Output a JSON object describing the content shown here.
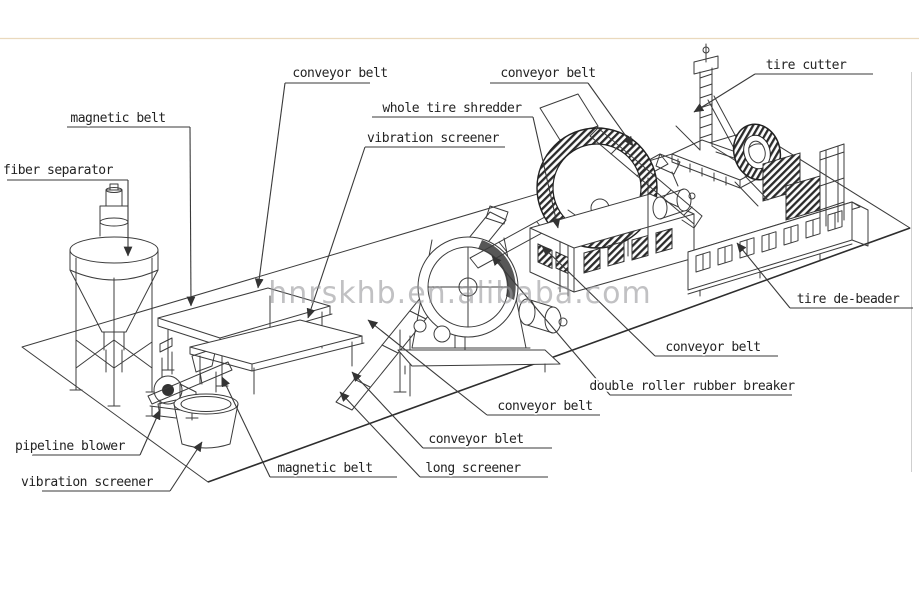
{
  "diagram": {
    "type": "isometric technical line drawing",
    "subject": "waste tire recycling production line",
    "watermark": "hnrskhb.en.alibaba.com",
    "colors": {
      "line": "#3c3c3c",
      "watermark": "#98989c",
      "top_rule": "#ead9bd",
      "background": "#ffffff"
    },
    "labels": [
      {
        "id": "conveyor-belt-top-left",
        "text": "conveyor belt"
      },
      {
        "id": "magnetic-belt-upper",
        "text": "magnetic belt"
      },
      {
        "id": "fiber-separator",
        "text": "fiber separator"
      },
      {
        "id": "whole-tire-shredder",
        "text": "whole tire shredder"
      },
      {
        "id": "vibration-screener-mid",
        "text": "vibration screener"
      },
      {
        "id": "conveyor-belt-top-mid",
        "text": "conveyor belt"
      },
      {
        "id": "tire-cutter",
        "text": "tire cutter"
      },
      {
        "id": "tire-de-beader",
        "text": "tire de-beader"
      },
      {
        "id": "conveyor-belt-right",
        "text": "conveyor belt"
      },
      {
        "id": "double-roller-rubber-breaker",
        "text": "double roller rubber breaker"
      },
      {
        "id": "conveyor-belt-lower-mid",
        "text": "conveyor belt"
      },
      {
        "id": "conveyor-blet",
        "text": "conveyor blet"
      },
      {
        "id": "long-screener",
        "text": "long screener"
      },
      {
        "id": "magnetic-belt-lower",
        "text": "magnetic belt"
      },
      {
        "id": "pipeline-blower",
        "text": "pipeline blower"
      },
      {
        "id": "vibration-screener-lower",
        "text": "vibration screener"
      }
    ]
  }
}
